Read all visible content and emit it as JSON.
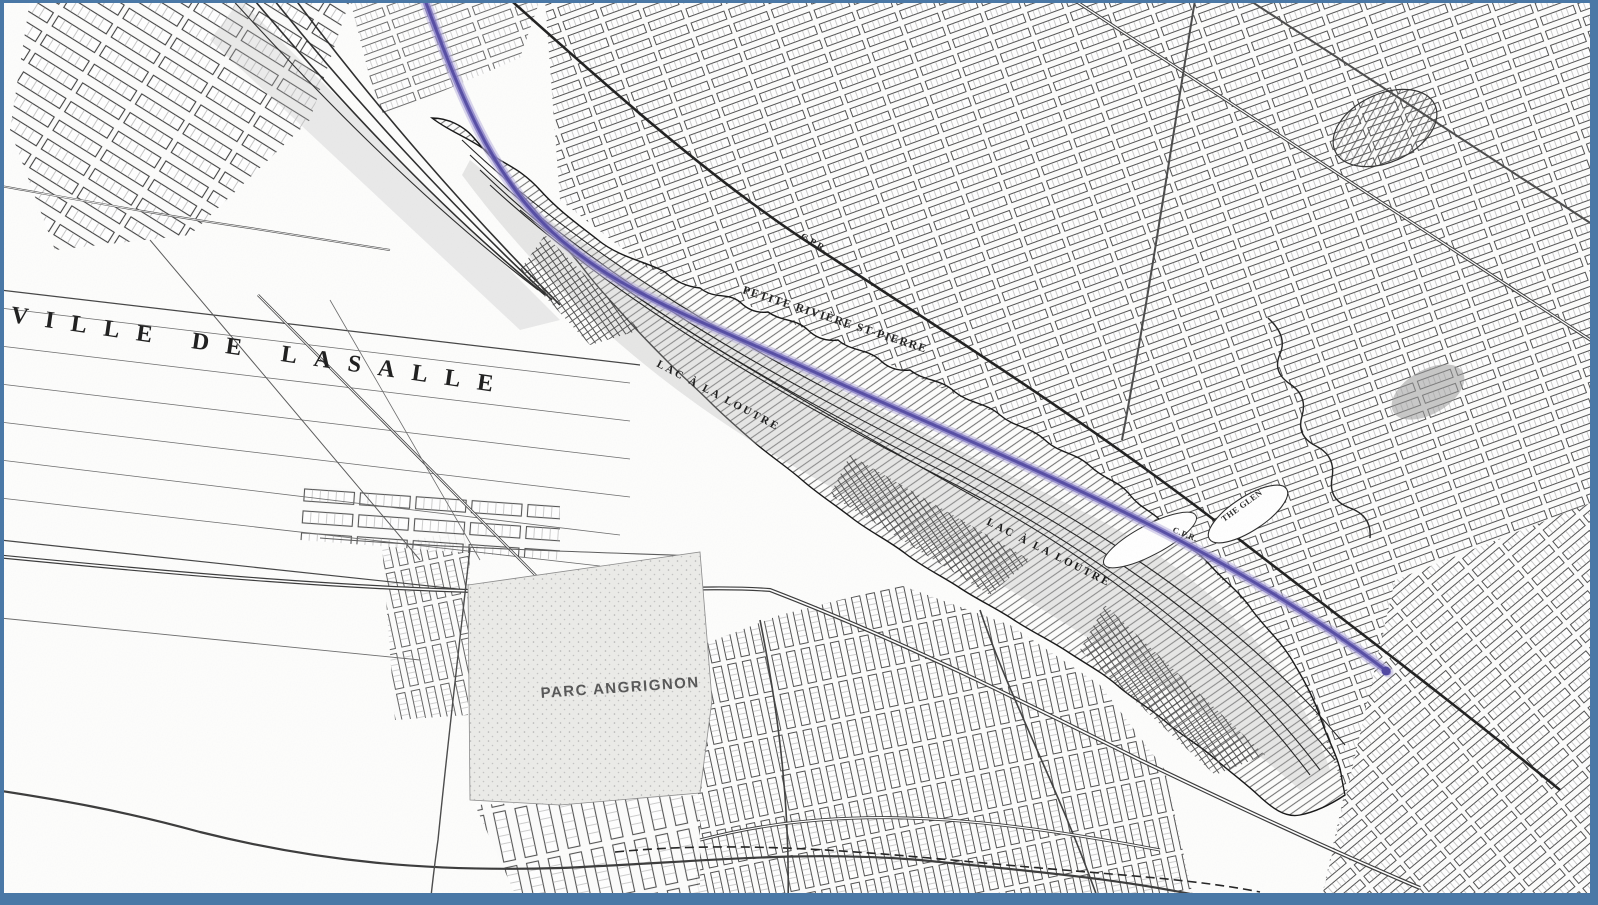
{
  "colors": {
    "frame_border": "#4a78a6",
    "paper": "#fdfdfc",
    "map_ink": "#2e2e2e",
    "route_halo": "#b9b2de",
    "route_mid": "#7d74c2",
    "route_core": "#4f46a0"
  },
  "map": {
    "description_labels_note": "historical survey map overlay",
    "labels": [
      {
        "id": "ville-de-lasalle",
        "text": "VILLE DE LASALLE",
        "x": 10,
        "y": 322,
        "rotation": 8.2,
        "font_size": 24,
        "letter_spacing": 17,
        "font_weight": 600,
        "color": "#1d1d1d"
      },
      {
        "id": "petite-riviere-st-pierre",
        "text": "PETITE RIVIÈRE ST-PIERRE",
        "x": 742,
        "y": 293,
        "rotation": 18,
        "font_size": 11.5,
        "letter_spacing": 1.5,
        "font_weight": 700,
        "color": "#202020"
      },
      {
        "id": "lac-a-la-loutre-1",
        "text": "LAC À LA LOUTRE",
        "x": 656,
        "y": 366,
        "rotation": 28,
        "font_size": 11,
        "letter_spacing": 2.5,
        "font_weight": 700,
        "color": "#1c1c1c"
      },
      {
        "id": "lac-a-la-loutre-2",
        "text": "LAC À LA LOUTRE",
        "x": 986,
        "y": 524,
        "rotation": 27,
        "font_size": 11,
        "letter_spacing": 2.5,
        "font_weight": 700,
        "color": "#161616"
      },
      {
        "id": "parc-angrignon",
        "text": "PARC ANGRIGNON",
        "x": 541,
        "y": 698,
        "rotation": -4,
        "font_size": 15,
        "letter_spacing": 1.5,
        "font_weight": 600,
        "color": "#565656"
      },
      {
        "id": "cpr-upper",
        "text": "C.P.R.",
        "x": 800,
        "y": 238,
        "rotation": 30,
        "font_size": 9.5,
        "letter_spacing": 0.5,
        "font_weight": 700,
        "color": "#222222"
      },
      {
        "id": "cpr-glen",
        "text": "C.P.R.",
        "x": 1172,
        "y": 532,
        "rotation": 22,
        "font_size": 8.5,
        "letter_spacing": 0.5,
        "font_weight": 700,
        "color": "#2a2a2a"
      },
      {
        "id": "the-glen",
        "text": "THE GLEN",
        "x": 1224,
        "y": 522,
        "rotation": -36,
        "font_size": 8.5,
        "letter_spacing": 0.5,
        "font_weight": 700,
        "color": "#2a2a2a"
      }
    ],
    "route_overlay": {
      "kind": "proposed-route-line",
      "start_edge": "top",
      "end_point_side": "east"
    }
  }
}
